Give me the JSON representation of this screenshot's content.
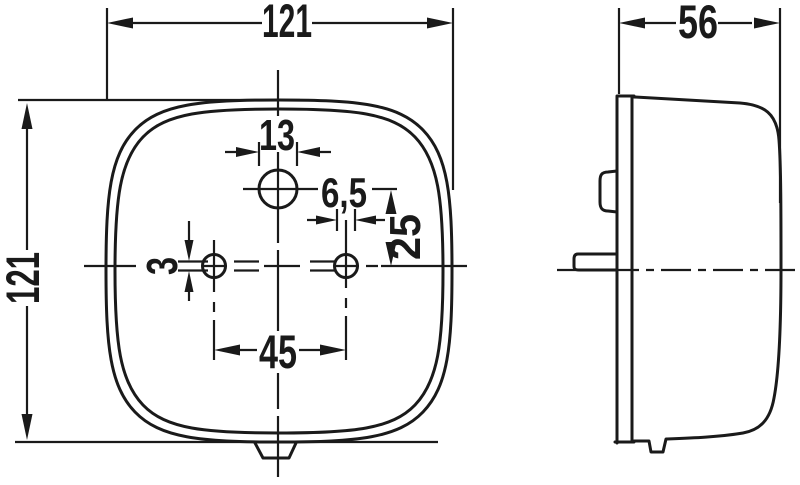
{
  "drawing": {
    "type": "technical-dimension-drawing",
    "views": [
      "front",
      "side"
    ],
    "colors": {
      "line": "#1a1a1a",
      "background": "#ffffff"
    }
  },
  "dimensions": {
    "overall_width": "121",
    "overall_height": "121",
    "depth": "56",
    "lens_hole_diameter": "13",
    "mounting_hole_diameter": "6,5",
    "hole_vertical_offset": "25",
    "slot_width": "3",
    "mounting_hole_spacing": "45"
  }
}
